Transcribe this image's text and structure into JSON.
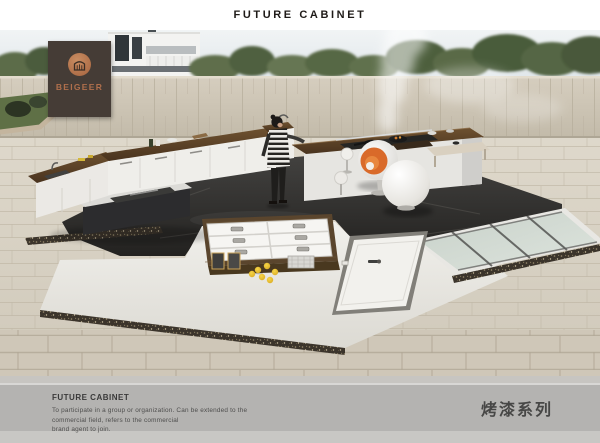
{
  "header": {
    "title": "FUTURE CABINET"
  },
  "brand": {
    "name": "BEIGEER",
    "banner_color": "#453c36",
    "accent_color": "#b06f4c",
    "logo_icon": "house-icon"
  },
  "footer": {
    "heading": "FUTURE CABINET",
    "body_lines": [
      "To participate in a group or organization. Can be extended to the",
      "commercial field, refers to the commercial",
      "brand agent to join.",
      "烤漆系列"
    ],
    "background_color": "#b4b3b1"
  }
}
